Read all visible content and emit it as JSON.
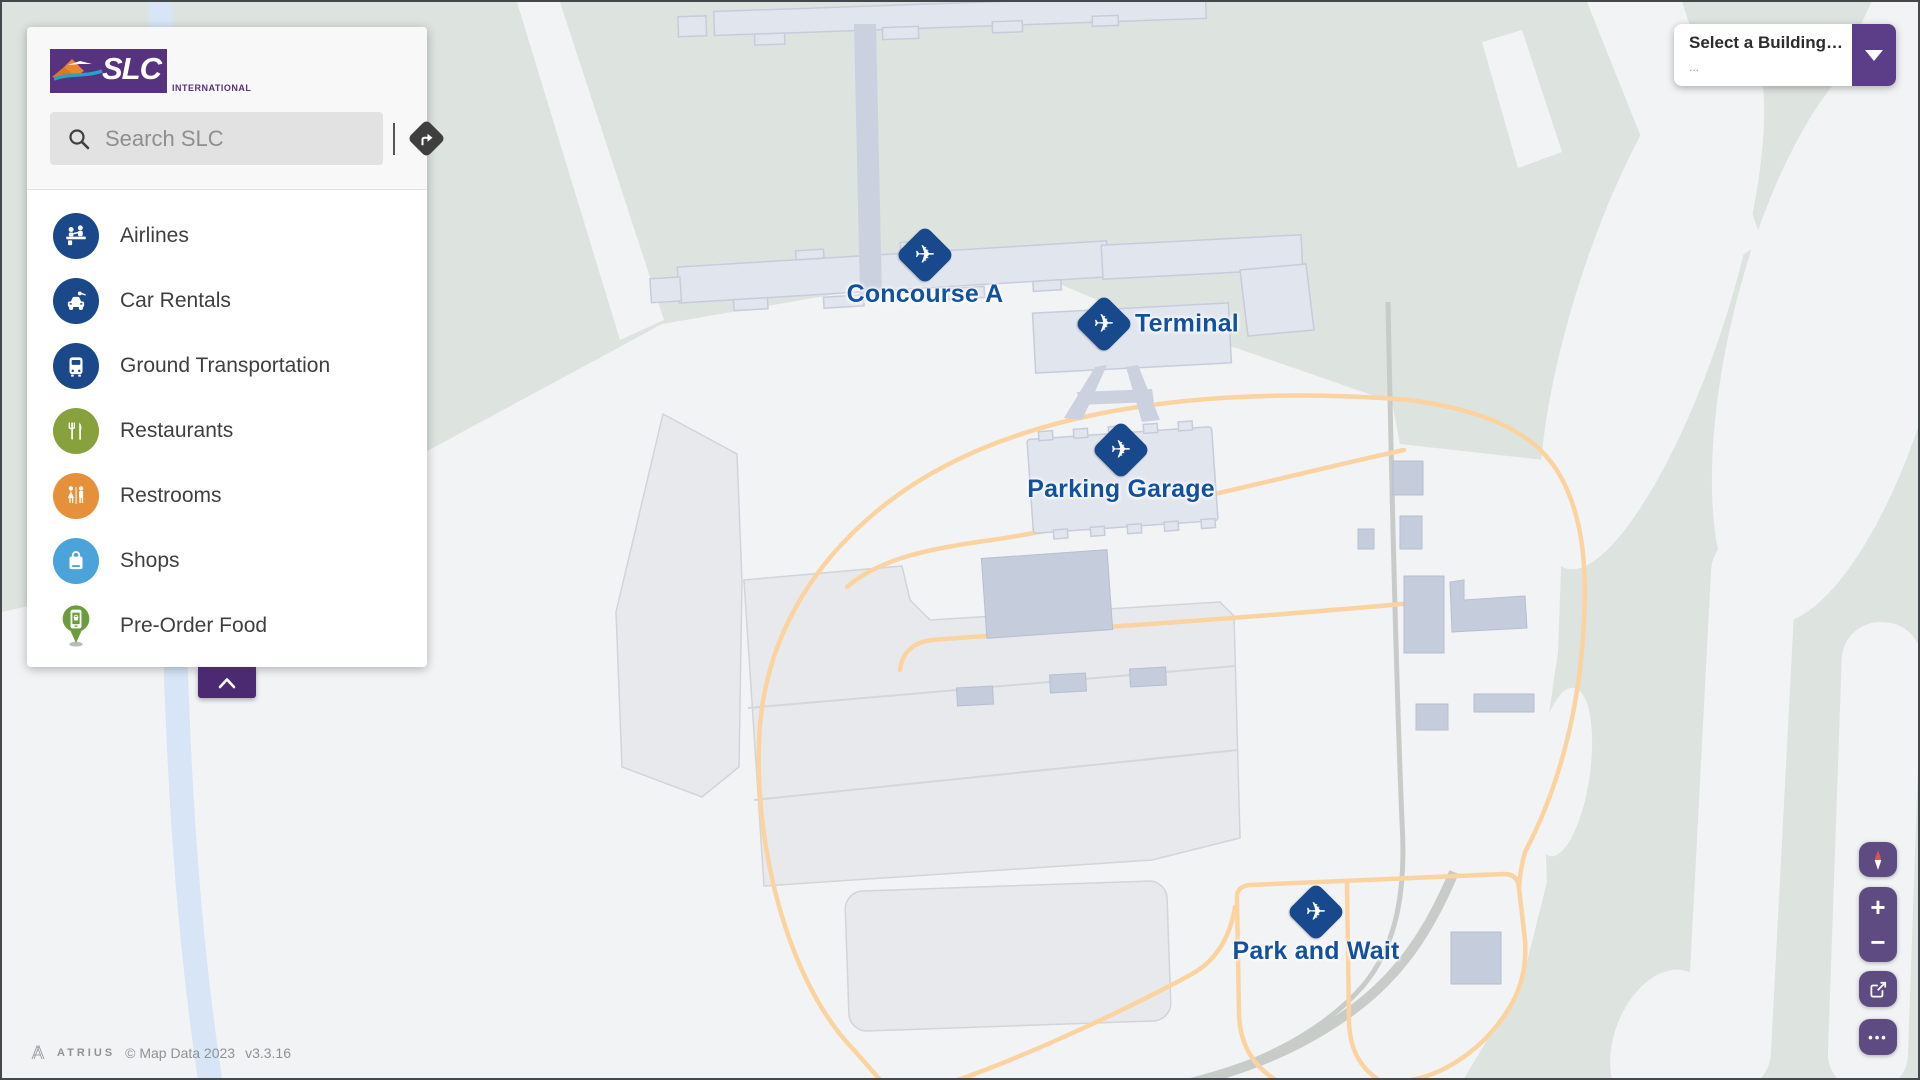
{
  "sidebar": {
    "logo": {
      "slc_text": "SLC",
      "international_text": "INTERNATIONAL",
      "purple": "#57327f",
      "orange": "#e8872e",
      "teal": "#2e9ec7"
    },
    "search": {
      "placeholder": "Search SLC"
    },
    "menu": [
      {
        "label": "Airlines",
        "icon": "airline-desk-icon",
        "color": "#1b4888"
      },
      {
        "label": "Car Rentals",
        "icon": "car-key-icon",
        "color": "#1b4888"
      },
      {
        "label": "Ground Transportation",
        "icon": "bus-icon",
        "color": "#1b4888"
      },
      {
        "label": "Restaurants",
        "icon": "fork-knife-icon",
        "color": "#87a23c"
      },
      {
        "label": "Restrooms",
        "icon": "man-woman-icon",
        "color": "#e6913a"
      },
      {
        "label": "Shops",
        "icon": "shopping-bag-icon",
        "color": "#4aa3d9"
      },
      {
        "label": "Pre-Order Food",
        "icon": "phone-basket-pin-icon",
        "color": "#6b9c3e"
      }
    ],
    "collapse_color": "#4c2a71"
  },
  "building_select": {
    "title": "Select a Building…",
    "subtitle": "...",
    "button_color": "#5c3d87"
  },
  "map_controls": {
    "zoom_in_label": "+",
    "zoom_out_label": "−",
    "more_label": "•••",
    "compass_red": "#d9534f",
    "button_color": "#5d4b82"
  },
  "map": {
    "markers": [
      {
        "id": "concourse-a",
        "label": "Concourse A"
      },
      {
        "id": "terminal",
        "label": "Terminal"
      },
      {
        "id": "parking-garage",
        "label": "Parking Garage"
      },
      {
        "id": "park-and-wait",
        "label": "Park and Wait"
      }
    ],
    "marker_color": "#17498c",
    "label_color": "#11519f",
    "attribution": {
      "brand": "ATRIUS",
      "copyright": "© Map Data 2023",
      "version": "v3.3.16"
    }
  },
  "map_palette": {
    "vegetation_green": "#dde3df",
    "paved_white": "#f2f3f5",
    "building": "#e1e5ee",
    "building_dark": "#c5ccdc",
    "walkway": "#cbd1df",
    "parking_lot": "#e8e9ec",
    "road_orange": "#fbd3a0",
    "river_blue": "#d7e5f7",
    "road_gray": "#c7ccc9"
  }
}
